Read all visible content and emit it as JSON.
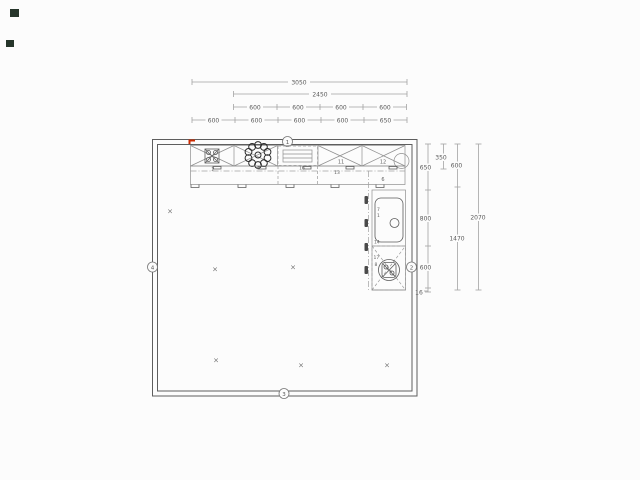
{
  "plan": {
    "floor_mark": "×",
    "wall_markers": [
      {
        "id": "1"
      },
      {
        "id": "2"
      },
      {
        "id": "3"
      },
      {
        "id": "4"
      }
    ],
    "dims_top": {
      "overall": "3050",
      "run": "2450",
      "row_upper": [
        "600",
        "600",
        "600",
        "600"
      ],
      "row_lower": [
        "600",
        "600",
        "600",
        "600",
        "650"
      ]
    },
    "dims_right": {
      "wall_col": [
        "650",
        "800",
        "600",
        "16"
      ],
      "depth": "350",
      "mid_col": [
        "600",
        "1470"
      ],
      "overall": "2070"
    },
    "items": {
      "hob_cabinet": "2",
      "wall_cabinet_a": "11",
      "wall_cabinet_b": "12",
      "hood": "16",
      "base_mid": "13",
      "corner_base": "6",
      "sink_a": "7",
      "sink_b": "1",
      "sink_c": "14",
      "appliance_a": "17",
      "appliance_b": "8"
    }
  }
}
